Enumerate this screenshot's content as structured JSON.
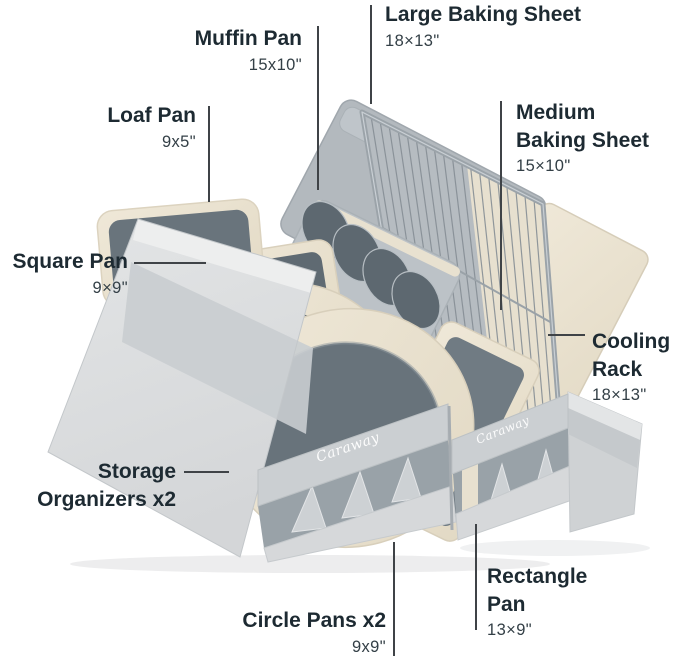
{
  "brand": {
    "logo_text": "Caraway"
  },
  "callouts": {
    "large_baking_sheet": {
      "lines": [
        "Large Baking Sheet"
      ],
      "dims": "18×13\""
    },
    "muffin_pan": {
      "lines": [
        "Muffin Pan"
      ],
      "dims": "15x10\""
    },
    "loaf_pan": {
      "lines": [
        "Loaf Pan"
      ],
      "dims": "9x5\""
    },
    "medium_baking_sheet": {
      "lines": [
        "Medium",
        "Baking Sheet"
      ],
      "dims": "15×10\""
    },
    "square_pan": {
      "lines": [
        "Square Pan"
      ],
      "dims": "9×9\""
    },
    "cooling_rack": {
      "lines": [
        "Cooling",
        "Rack"
      ],
      "dims": "18×13\""
    },
    "storage_organizers": {
      "lines": [
        "Storage",
        "Organizers x2"
      ]
    },
    "rectangle_pan": {
      "lines": [
        "Rectangle",
        "Pan"
      ],
      "dims": "13×9\""
    },
    "circle_pans": {
      "lines": [
        "Circle Pans x2"
      ],
      "dims": "9x9\""
    }
  },
  "colors": {
    "background": "#ffffff",
    "label_text": "#1d2a32",
    "dims_text": "#333f46",
    "leader_line": "#3f4347",
    "pan_cream": "#e9e1d0",
    "pan_interior_gray": "#66717a",
    "sheet_gray": "#b6bcc1",
    "organizer_fabric": "#dbdddf",
    "strap_fabric": "#cbcfd2",
    "logo_text_color": "#ffffff"
  }
}
